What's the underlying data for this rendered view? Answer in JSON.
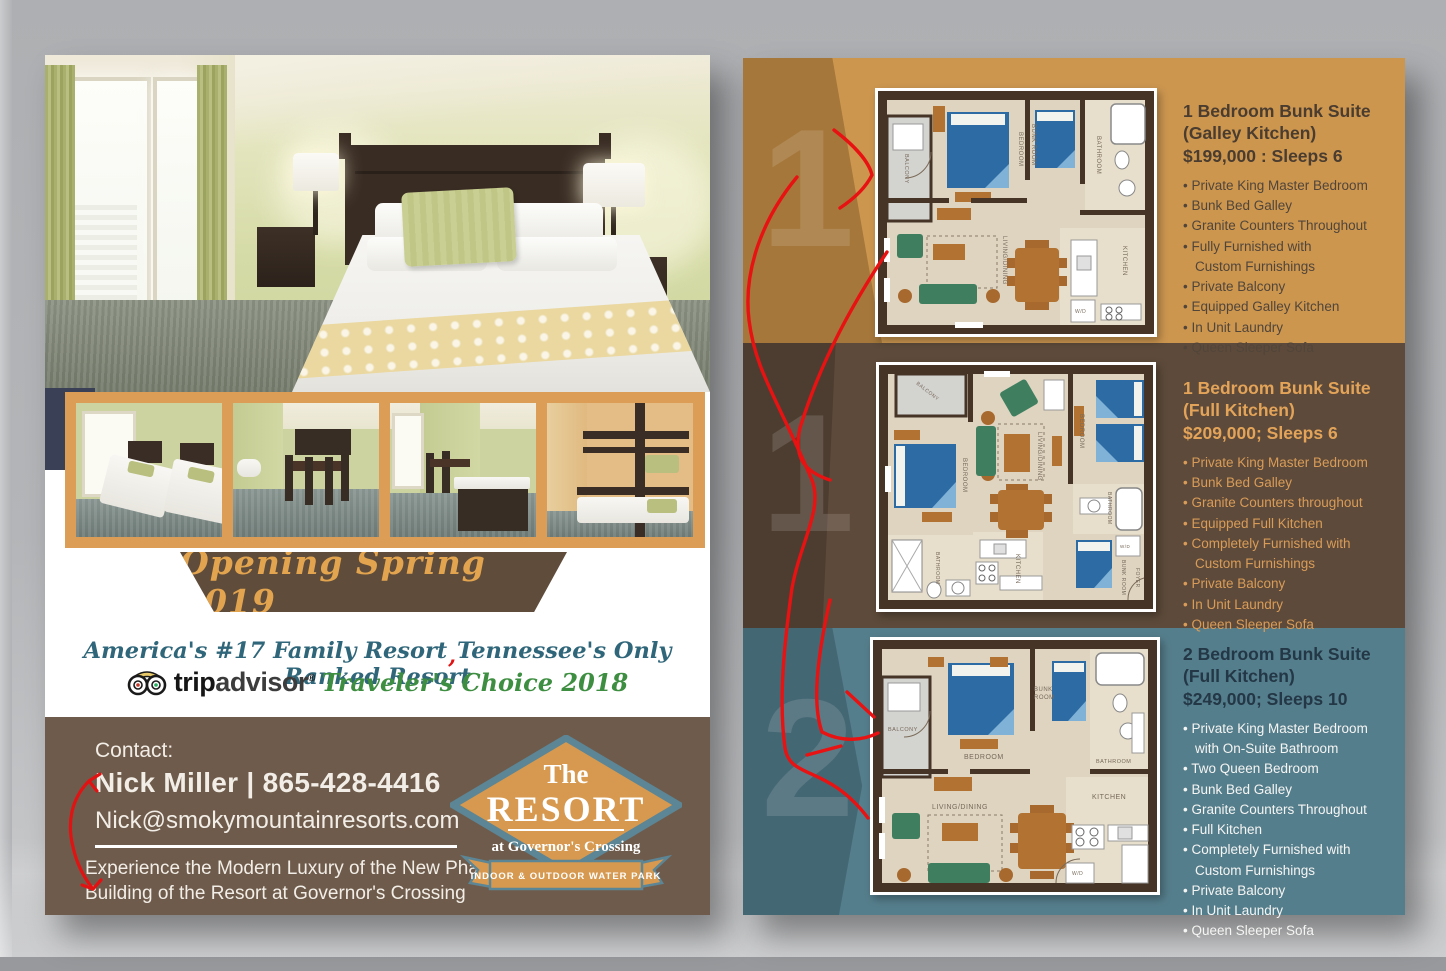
{
  "left_page": {
    "banner_text": "Opening Spring 2019",
    "tagline": {
      "part1": "America's #17 Family Resort",
      "red_comma": ",",
      "part2": "Tennessee's Only Ranked Resort"
    },
    "tripadvisor": {
      "trip": "trip",
      "advisor": "advisor",
      "registered": "®",
      "award": "Traveler's Choice 2018"
    },
    "contact": {
      "label": "Contact:",
      "name_phone": "Nick Miller | 865-428-4416",
      "email": "Nick@smokymountainresorts.com",
      "blurb": "Experience the Modern Luxury of the New Phase 3\nBuilding of the Resort at Governor's Crossing"
    },
    "logo": {
      "the": "The",
      "resort": "RESORT",
      "location": "at Governor's Crossing",
      "ribbon": "INDOOR & OUTDOOR WATER PARK"
    }
  },
  "right_page": {
    "sections": [
      {
        "number": "1",
        "title": "1 Bedroom Bunk Suite",
        "subtitle": "(Galley Kitchen)",
        "price": "$199,000 : Sleeps 6",
        "bullets": [
          "Private King Master Bedroom",
          "Bunk Bed Galley",
          "Granite Counters Throughout",
          "Fully Furnished with\nCustom Furnishings",
          "Private Balcony",
          "Equipped Galley Kitchen",
          "In Unit Laundry",
          "Queen Sleeper Sofa"
        ]
      },
      {
        "number": "1",
        "title": "1 Bedroom Bunk Suite",
        "subtitle": "(Full Kitchen)",
        "price": "$209,000; Sleeps 6",
        "bullets": [
          "Private King Master Bedroom",
          "Bunk Bed Galley",
          "Granite Counters throughout",
          "Equipped Full Kitchen",
          "Completely Furnished with\nCustom Furnishings",
          "Private Balcony",
          "In Unit Laundry",
          "Queen Sleeper Sofa"
        ]
      },
      {
        "number": "2",
        "title": "2 Bedroom Bunk Suite",
        "subtitle": "(Full Kitchen)",
        "price": "$249,000; Sleeps 10",
        "bullets": [
          "Private King Master Bedroom\nwith On-Suite Bathroom",
          "Two Queen Bedroom",
          "Bunk Bed Galley",
          "Granite Counters Throughout",
          "Full Kitchen",
          "Completely Furnished with\nCustom Furnishings",
          "Private Balcony",
          "In Unit Laundry",
          "Queen Sleeper Sofa"
        ]
      }
    ],
    "floorplan_labels": {
      "plan1": {
        "balcony": "BALCONY",
        "bedroom": "BEDROOM",
        "bunkroom": "BUNK ROOM",
        "bathroom": "BATHROOM",
        "living": "LIVING/DINING",
        "kitchen": "KITCHEN",
        "wd": "W/D"
      },
      "plan2": {
        "balcony": "BALCONY",
        "bedroom_left": "BEDROOM",
        "living": "LIVING/DINING",
        "bedroom_right": "BEDROOM",
        "bathroom_left": "BATHROOM",
        "kitchen": "KITCHEN",
        "bathroom_right": "BATHROOM",
        "bunkroom": "BUNK ROOM",
        "foyer": "FOYER",
        "wd": "W/D"
      },
      "plan3": {
        "balcony": "BALCONY",
        "bedroom": "BEDROOM",
        "bunk_line1": "BUNK",
        "bunk_line2": "ROOM",
        "bathroom": "BATHROOM",
        "living": "LIVING/DINING",
        "kitchen": "KITCHEN",
        "wd": "W/D"
      }
    }
  },
  "colors": {
    "band_orange": "#cc964f",
    "band_brown": "#5d4a3a",
    "band_teal": "#557e8c",
    "banner_brown": "#5f4c3b",
    "contact_brown": "#6e5b4b",
    "accent_orange_text": "#e2a44f",
    "tagline_teal": "#2f6679",
    "award_green": "#3e8e41",
    "annotation_red": "#e31212",
    "bed_blue": "#2d6ba5",
    "sofa_green": "#3f7f60",
    "wood_brown": "#b17232"
  }
}
